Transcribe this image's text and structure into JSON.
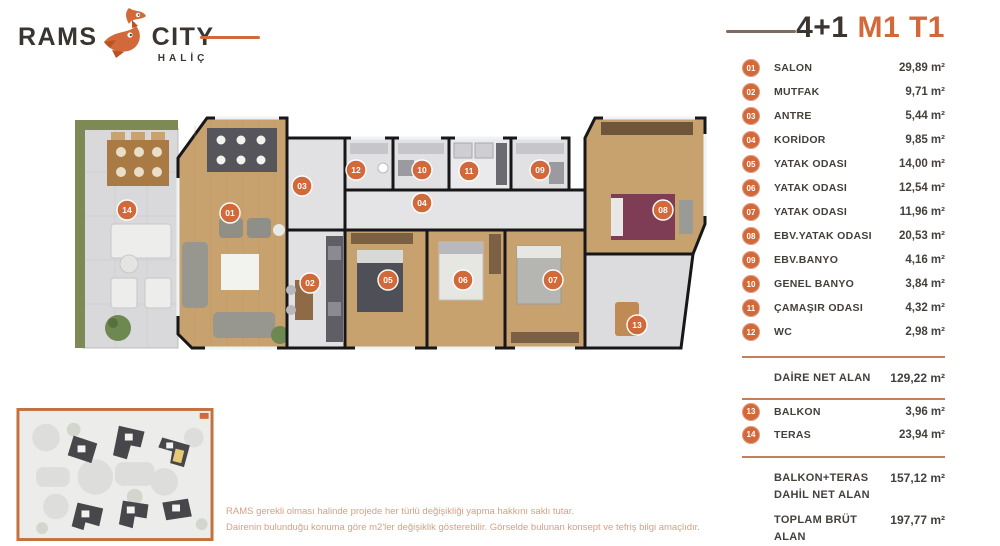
{
  "header": {
    "logo": {
      "rams": "RAMS",
      "city": "CITY",
      "halic": "HALİÇ"
    },
    "plan_type": "4+1",
    "variant": "M1 T1"
  },
  "accent_color": "#d2693a",
  "room_list": {
    "unit": "m²",
    "rooms": [
      {
        "num": "01",
        "label": "SALON",
        "area": "29,89"
      },
      {
        "num": "02",
        "label": "MUTFAK",
        "area": "9,71"
      },
      {
        "num": "03",
        "label": "ANTRE",
        "area": "5,44"
      },
      {
        "num": "04",
        "label": "KORİDOR",
        "area": "9,85"
      },
      {
        "num": "05",
        "label": "YATAK ODASI",
        "area": "14,00"
      },
      {
        "num": "06",
        "label": "YATAK ODASI",
        "area": "12,54"
      },
      {
        "num": "07",
        "label": "YATAK ODASI",
        "area": "11,96"
      },
      {
        "num": "08",
        "label": "EBV.YATAK ODASI",
        "area": "20,53"
      },
      {
        "num": "09",
        "label": "EBV.BANYO",
        "area": "4,16"
      },
      {
        "num": "10",
        "label": "GENEL BANYO",
        "area": "3,84"
      },
      {
        "num": "11",
        "label": "ÇAMAŞIR ODASI",
        "area": "4,32"
      },
      {
        "num": "12",
        "label": "WC",
        "area": "2,98"
      }
    ],
    "net": {
      "label": "DAİRE NET ALAN",
      "area": "129,22"
    },
    "outdoor": [
      {
        "num": "13",
        "label": "BALKON",
        "area": "3,96"
      },
      {
        "num": "14",
        "label": "TERAS",
        "area": "23,94"
      }
    ],
    "totals": [
      {
        "label": "BALKON+TERAS DAHİL NET ALAN",
        "area": "157,12"
      },
      {
        "label": "TOPLAM BRÜT ALAN",
        "area": "197,77"
      }
    ]
  },
  "plan": {
    "badges": [
      {
        "label": "01",
        "x": 175,
        "y": 107
      },
      {
        "label": "02",
        "x": 255,
        "y": 177
      },
      {
        "label": "03",
        "x": 247,
        "y": 80
      },
      {
        "label": "04",
        "x": 367,
        "y": 97
      },
      {
        "label": "05",
        "x": 333,
        "y": 174
      },
      {
        "label": "06",
        "x": 408,
        "y": 174
      },
      {
        "label": "07",
        "x": 498,
        "y": 174
      },
      {
        "label": "08",
        "x": 608,
        "y": 104
      },
      {
        "label": "09",
        "x": 485,
        "y": 64
      },
      {
        "label": "10",
        "x": 367,
        "y": 64
      },
      {
        "label": "11",
        "x": 414,
        "y": 65
      },
      {
        "label": "12",
        "x": 301,
        "y": 64
      },
      {
        "label": "13",
        "x": 582,
        "y": 219
      },
      {
        "label": "14",
        "x": 72,
        "y": 104
      }
    ]
  },
  "disclaimer": {
    "line1": "RAMS gerekli olması halinde projede her türlü değişikliği yapma hakkını saklı tutar.",
    "line2": "Dairenin bulunduğu konuma göre m2'ler değişiklik gösterebilir. Görselde bulunan konsept ve tefriş bilgi amaçlıdır."
  }
}
